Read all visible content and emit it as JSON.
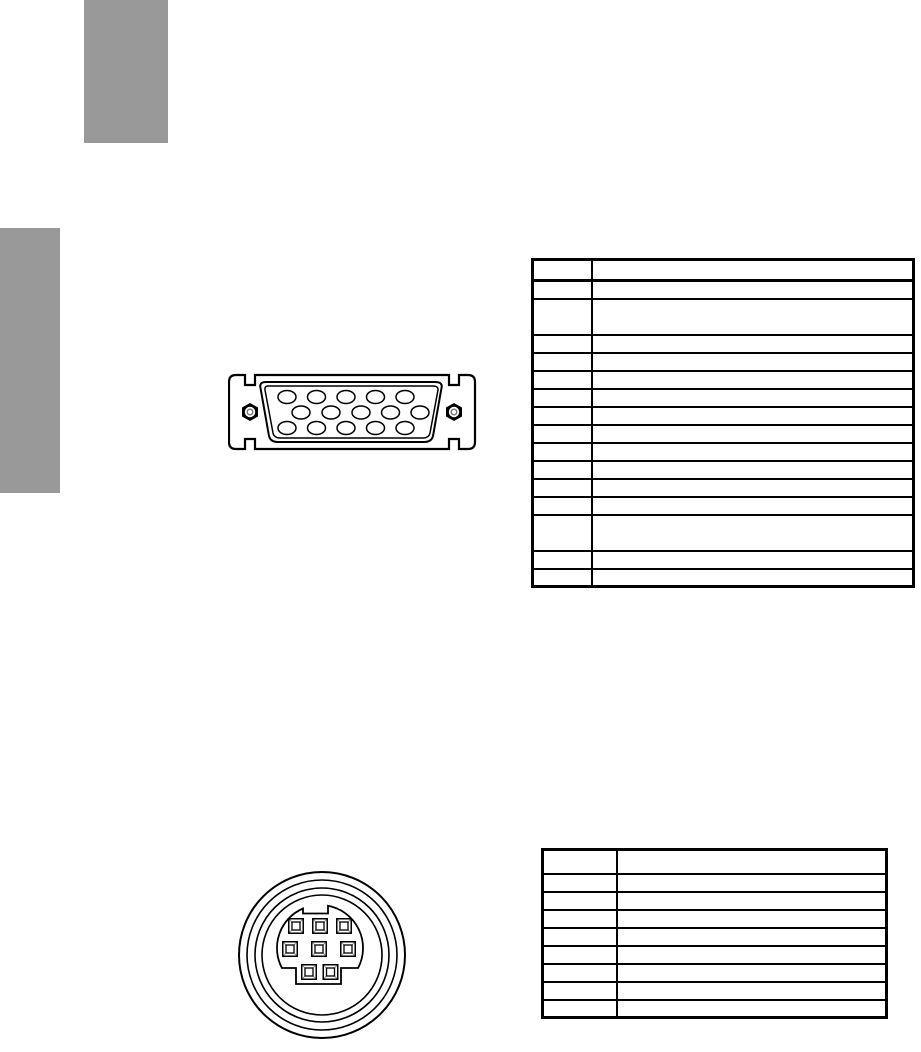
{
  "page": {
    "width": 921,
    "height": 1052,
    "background": "#ffffff"
  },
  "decorations": {
    "header_block": {
      "color": "#999999"
    },
    "side_tab_block": {
      "color": "#999999"
    }
  },
  "figures": {
    "vga_connector": {
      "name": "d-sub-15-pin-connector-diagram",
      "pin_holes": 15,
      "pin_rows": [
        5,
        5,
        5
      ],
      "screws": 2,
      "line_color": "#000000"
    },
    "minidin_connector": {
      "name": "mini-din-8-pin-connector-diagram",
      "pin_holes": 8,
      "pin_rows": [
        3,
        3,
        2
      ],
      "concentric_rings": 4,
      "line_color": "#000000"
    }
  },
  "tables": {
    "dsub_pin_table": {
      "border_color": "#000000",
      "column_count": 2,
      "row_count": 16,
      "rows": [
        {
          "type": "h",
          "cells": [
            "",
            ""
          ]
        },
        {
          "type": "n",
          "cells": [
            "",
            ""
          ]
        },
        {
          "type": "d",
          "cells": [
            "",
            ""
          ]
        },
        {
          "type": "n",
          "cells": [
            "",
            ""
          ]
        },
        {
          "type": "n",
          "cells": [
            "",
            ""
          ]
        },
        {
          "type": "n",
          "cells": [
            "",
            ""
          ]
        },
        {
          "type": "n",
          "cells": [
            "",
            ""
          ]
        },
        {
          "type": "n",
          "cells": [
            "",
            ""
          ]
        },
        {
          "type": "n",
          "cells": [
            "",
            ""
          ]
        },
        {
          "type": "n",
          "cells": [
            "",
            ""
          ]
        },
        {
          "type": "n",
          "cells": [
            "",
            ""
          ]
        },
        {
          "type": "n",
          "cells": [
            "",
            ""
          ]
        },
        {
          "type": "n",
          "cells": [
            "",
            ""
          ]
        },
        {
          "type": "d",
          "cells": [
            "",
            ""
          ]
        },
        {
          "type": "n",
          "cells": [
            "",
            ""
          ]
        },
        {
          "type": "n",
          "cells": [
            "",
            ""
          ]
        }
      ]
    },
    "minidin_pin_table": {
      "border_color": "#000000",
      "column_count": 2,
      "row_count": 9,
      "rows": [
        {
          "type": "h",
          "cells": [
            "",
            ""
          ]
        },
        {
          "type": "n",
          "cells": [
            "",
            ""
          ]
        },
        {
          "type": "n",
          "cells": [
            "",
            ""
          ]
        },
        {
          "type": "n",
          "cells": [
            "",
            ""
          ]
        },
        {
          "type": "n",
          "cells": [
            "",
            ""
          ]
        },
        {
          "type": "n",
          "cells": [
            "",
            ""
          ]
        },
        {
          "type": "n",
          "cells": [
            "",
            ""
          ]
        },
        {
          "type": "n",
          "cells": [
            "",
            ""
          ]
        },
        {
          "type": "n",
          "cells": [
            "",
            ""
          ]
        }
      ]
    }
  }
}
